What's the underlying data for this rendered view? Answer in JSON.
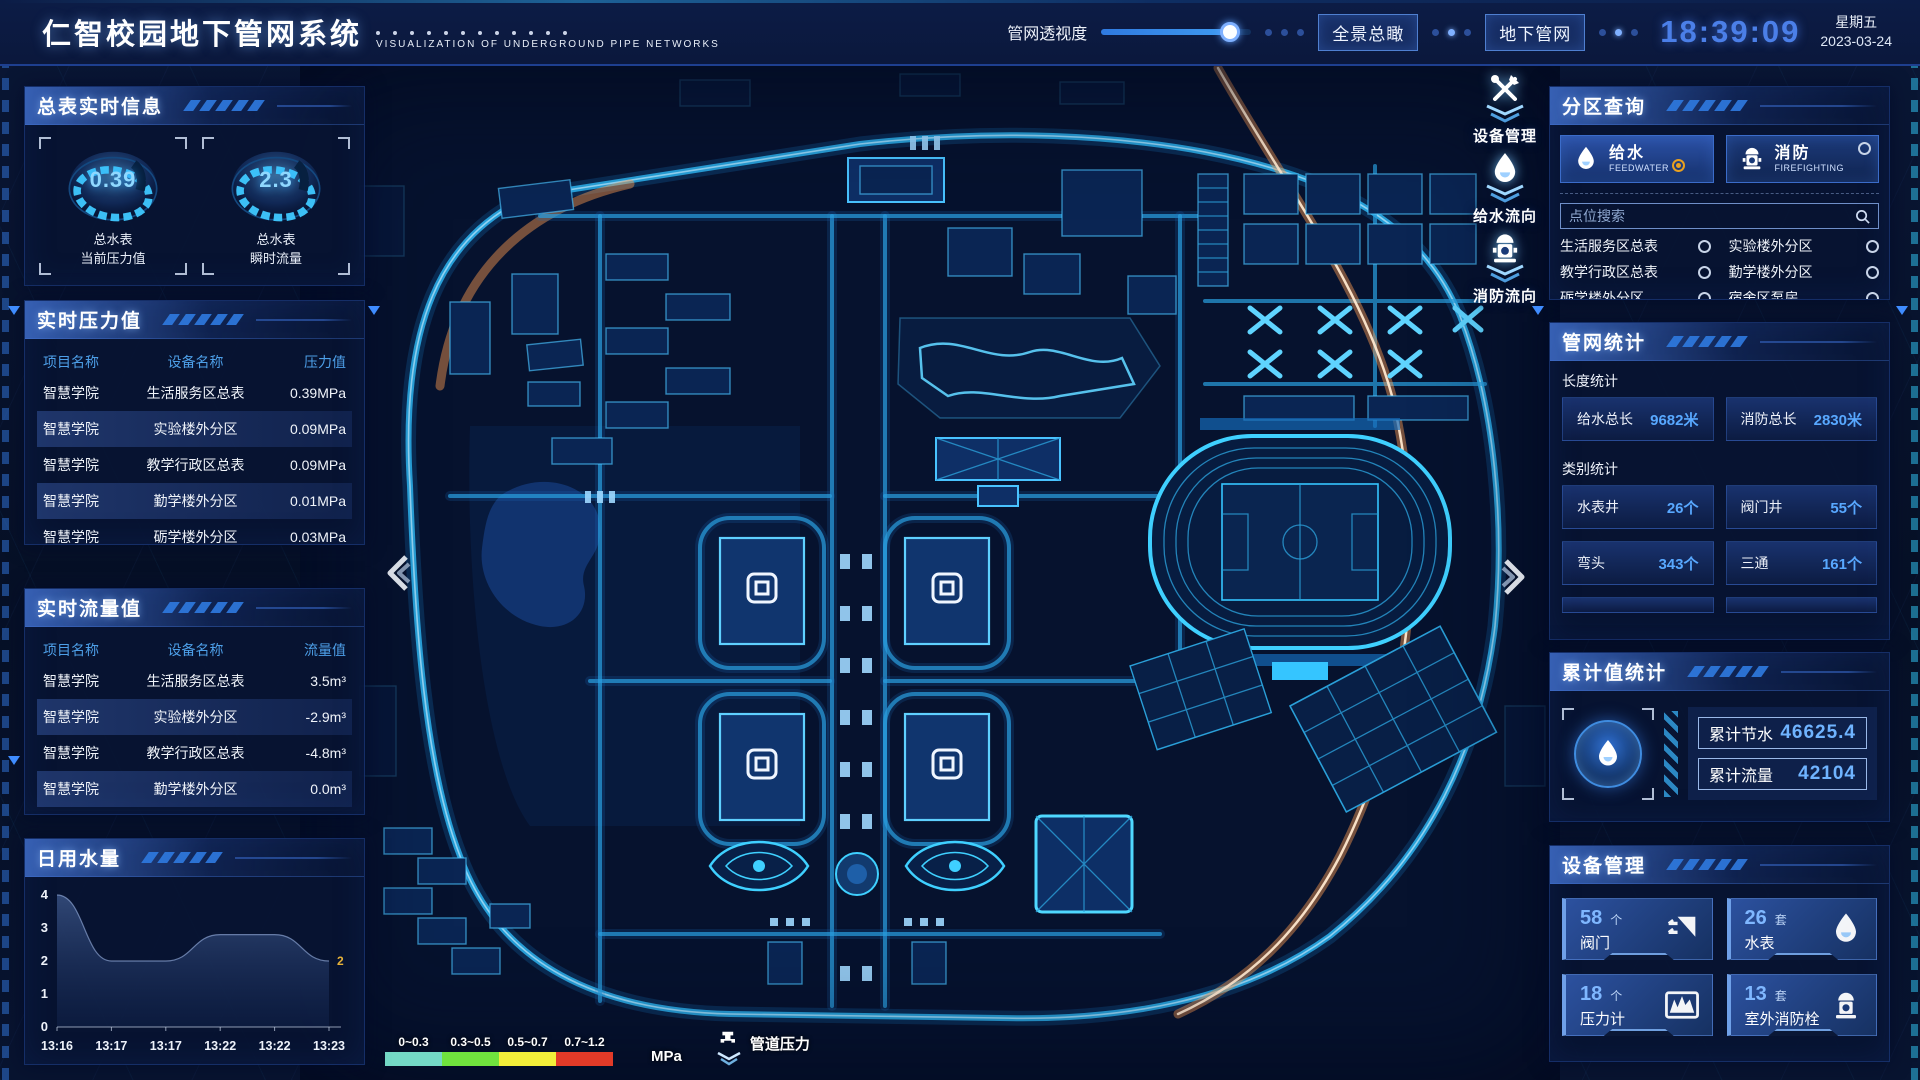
{
  "header": {
    "title": "仁智校园地下管网系统",
    "subtitle": "VISUALIZATION OF UNDERGROUND PIPE NETWORKS",
    "opacity_label": "管网透视度",
    "opacity_percent": 86,
    "buttons": [
      {
        "label": "全景总瞰"
      },
      {
        "label": "地下管网"
      }
    ],
    "clock": {
      "time": "18:39:09",
      "weekday": "星期五",
      "date": "2023-03-24"
    }
  },
  "left": {
    "realtime_info": {
      "title": "总表实时信息",
      "gauges": [
        {
          "value": "0.39",
          "label1": "总水表",
          "label2": "当前压力值"
        },
        {
          "value": "2.3",
          "label1": "总水表",
          "label2": "瞬时流量"
        }
      ]
    },
    "pressure": {
      "title": "实时压力值",
      "headers": [
        "项目名称",
        "设备名称",
        "压力值"
      ],
      "rows": [
        [
          "智慧学院",
          "生活服务区总表",
          "0.39MPa"
        ],
        [
          "智慧学院",
          "实验楼外分区",
          "0.09MPa"
        ],
        [
          "智慧学院",
          "教学行政区总表",
          "0.09MPa"
        ],
        [
          "智慧学院",
          "勤学楼外分区",
          "0.01MPa"
        ],
        [
          "智慧学院",
          "砺学楼外分区",
          "0.03MPa"
        ]
      ]
    },
    "flow": {
      "title": "实时流量值",
      "headers": [
        "项目名称",
        "设备名称",
        "流量值"
      ],
      "rows": [
        [
          "智慧学院",
          "生活服务区总表",
          "3.5m³"
        ],
        [
          "智慧学院",
          "实验楼外分区",
          "-2.9m³"
        ],
        [
          "智慧学院",
          "教学行政区总表",
          "-4.8m³"
        ],
        [
          "智慧学院",
          "勤学楼外分区",
          "0.0m³"
        ],
        [
          "智慧学院",
          "砺学楼外分区",
          "-2.3m³"
        ]
      ]
    },
    "daily_water": {
      "title": "日用水量"
    }
  },
  "chart_data": {
    "type": "area",
    "title": "日用水量",
    "x": [
      "13:16",
      "13:17",
      "13:17",
      "13:22",
      "13:22",
      "13:23"
    ],
    "values": [
      4,
      2,
      2,
      2.8,
      2.8,
      2
    ],
    "ylim": [
      0,
      4
    ],
    "yticks": [
      0,
      1,
      2,
      3,
      4
    ],
    "grid": false,
    "last_point_label": "2",
    "last_point_label_color": "#e8b339"
  },
  "map": {
    "tools": [
      {
        "label": "设备管理",
        "icon": "tools-wrench-icon"
      },
      {
        "label": "给水流向",
        "icon": "water-drop-icon"
      },
      {
        "label": "消防流向",
        "icon": "hydrant-icon"
      }
    ],
    "legend": {
      "ranges": [
        {
          "label": "0~0.3",
          "color": "#74d9c6"
        },
        {
          "label": "0.3~0.5",
          "color": "#70e33e"
        },
        {
          "label": "0.5~0.7",
          "color": "#f2ee3a"
        },
        {
          "label": "0.7~1.2",
          "color": "#e23a28"
        }
      ],
      "unit": "MPa",
      "pressure_label": "管道压力",
      "pressure_icon": "faucet-icon"
    }
  },
  "right": {
    "zone_query": {
      "title": "分区查询",
      "tabs": [
        {
          "label": "给水",
          "sub": "FEEDWATER",
          "icon": "water-drop-icon",
          "selected": true
        },
        {
          "label": "消防",
          "sub": "FIREFIGHTING",
          "icon": "hydrant-icon",
          "selected": false
        }
      ],
      "search_placeholder": "点位搜索",
      "points": [
        "生活服务区总表",
        "实验楼外分区",
        "教学行政区总表",
        "勤学楼外分区",
        "砺学楼外分区",
        "宿舍区泵房"
      ]
    },
    "pipe_stats": {
      "title": "管网统计",
      "length_title": "长度统计",
      "length_items": [
        {
          "label": "给水总长",
          "value": "9682米"
        },
        {
          "label": "消防总长",
          "value": "2830米"
        }
      ],
      "category_title": "类别统计",
      "category_items": [
        {
          "label": "水表井",
          "value": "26个"
        },
        {
          "label": "阀门井",
          "value": "55个"
        },
        {
          "label": "弯头",
          "value": "343个"
        },
        {
          "label": "三通",
          "value": "161个"
        }
      ]
    },
    "cumulative": {
      "title": "累计值统计",
      "icon": "water-drop-icon",
      "items": [
        {
          "label": "累计节水",
          "value": "46625.4"
        },
        {
          "label": "累计流量",
          "value": "42104"
        }
      ]
    },
    "devices": {
      "title": "设备管理",
      "cards": [
        {
          "count": "58",
          "unit": "个",
          "label": "阀门",
          "icon": "valve-icon"
        },
        {
          "count": "26",
          "unit": "套",
          "label": "水表",
          "icon": "water-meter-icon"
        },
        {
          "count": "18",
          "unit": "个",
          "label": "压力计",
          "icon": "pressure-gauge-icon"
        },
        {
          "count": "13",
          "unit": "套",
          "label": "室外消防栓",
          "icon": "outdoor-hydrant-icon"
        }
      ]
    }
  },
  "colors": {
    "accent_blue": "#3f8cff",
    "cyan": "#35c5ff",
    "value_blue": "#58a8ff",
    "time_blue": "#4b7fe8",
    "selected_radio": "#e8a020"
  }
}
